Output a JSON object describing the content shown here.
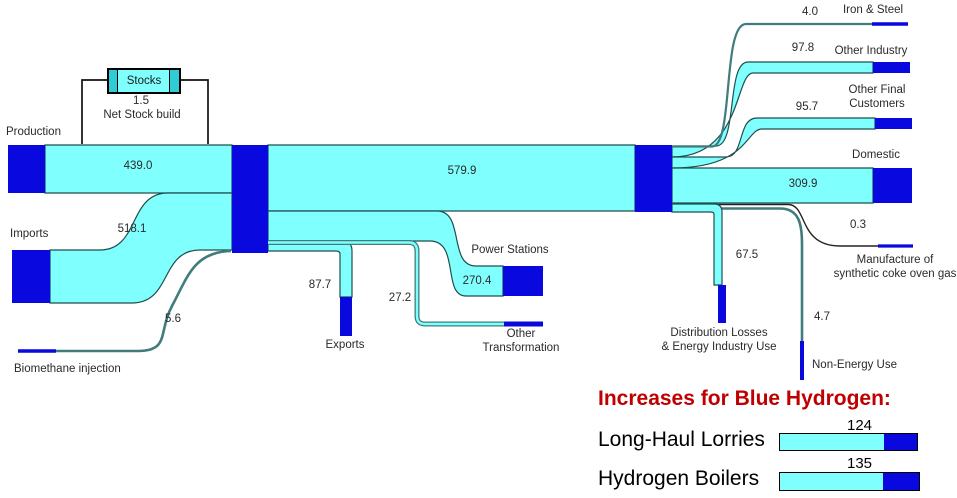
{
  "colors": {
    "flow_cyan": "#80FFFF",
    "node_blue": "#0808DF",
    "thin_flow_teal": "#407C7C",
    "band_outline": "#1F4E4E",
    "stock_line_black": "#111111",
    "heading_red": "#C00000",
    "stocks_cap_teal": "#2FCCD6"
  },
  "chart_data": {
    "type": "sankey",
    "title": "",
    "description": "Natural gas flow Sankey diagram with Blue Hydrogen increase annotation",
    "flows": [
      {
        "from": "Production",
        "to": "Gas Network",
        "value": 439.0
      },
      {
        "from": "Imports",
        "to": "Gas Network",
        "value": 518.1
      },
      {
        "from": "Biomethane injection",
        "to": "Gas Network",
        "value": 5.6
      },
      {
        "from": "Gas Network",
        "to": "Stocks",
        "value": 1.5,
        "note": "Net Stock build"
      },
      {
        "from": "Gas Network",
        "to": "Exports",
        "value": 87.7
      },
      {
        "from": "Gas Network",
        "to": "Power Stations",
        "value": 270.4
      },
      {
        "from": "Gas Network",
        "to": "Other Transformation",
        "value": 27.2
      },
      {
        "from": "Gas Network",
        "to": "Final Consumers",
        "value": 579.9
      },
      {
        "from": "Final Consumers",
        "to": "Iron & Steel",
        "value": 4.0
      },
      {
        "from": "Final Consumers",
        "to": "Other Industry",
        "value": 97.8
      },
      {
        "from": "Final Consumers",
        "to": "Other Final Customers",
        "value": 95.7
      },
      {
        "from": "Final Consumers",
        "to": "Domestic",
        "value": 309.9
      },
      {
        "from": "Final Consumers",
        "to": "Manufacture of synthetic coke oven gas",
        "value": 0.3
      },
      {
        "from": "Final Consumers",
        "to": "Distribution Losses & Energy Industry Use",
        "value": 67.5
      },
      {
        "from": "Final Consumers",
        "to": "Non-Energy Use",
        "value": 4.7
      }
    ],
    "annotation_bars": {
      "title": "Increases for Blue Hydrogen:",
      "items": [
        {
          "label": "Long-Haul Lorries",
          "value": "124"
        },
        {
          "label": "Hydrogen Boilers",
          "value": "135"
        }
      ]
    }
  },
  "labels": {
    "production": "Production",
    "production_value": "439.0",
    "stocks": "Stocks",
    "stock_value": "1.5",
    "stock_caption": "Net Stock build",
    "imports": "Imports",
    "imports_value": "518.1",
    "biomethane_value": "5.6",
    "biomethane": "Biomethane injection",
    "main_value": "579.9",
    "exports_value": "87.7",
    "exports": "Exports",
    "other_transformation_value": "27.2",
    "other_transformation_1": "Other",
    "other_transformation_2": "Transformation",
    "power_stations": "Power Stations",
    "power_stations_value": "270.4",
    "iron_steel_value": "4.0",
    "iron_steel": "Iron & Steel",
    "other_industry_value": "97.8",
    "other_industry": "Other Industry",
    "other_final_value": "95.7",
    "other_final_1": "Other Final",
    "other_final_2": "Customers",
    "domestic": "Domestic",
    "domestic_value": "309.9",
    "coke_value": "0.3",
    "coke_1": "Manufacture of",
    "coke_2": "synthetic coke oven gas",
    "dist_value": "67.5",
    "dist_1": "Distribution Losses",
    "dist_2": "& Energy Industry Use",
    "non_energy_value": "4.7",
    "non_energy": "Non-Energy Use"
  }
}
